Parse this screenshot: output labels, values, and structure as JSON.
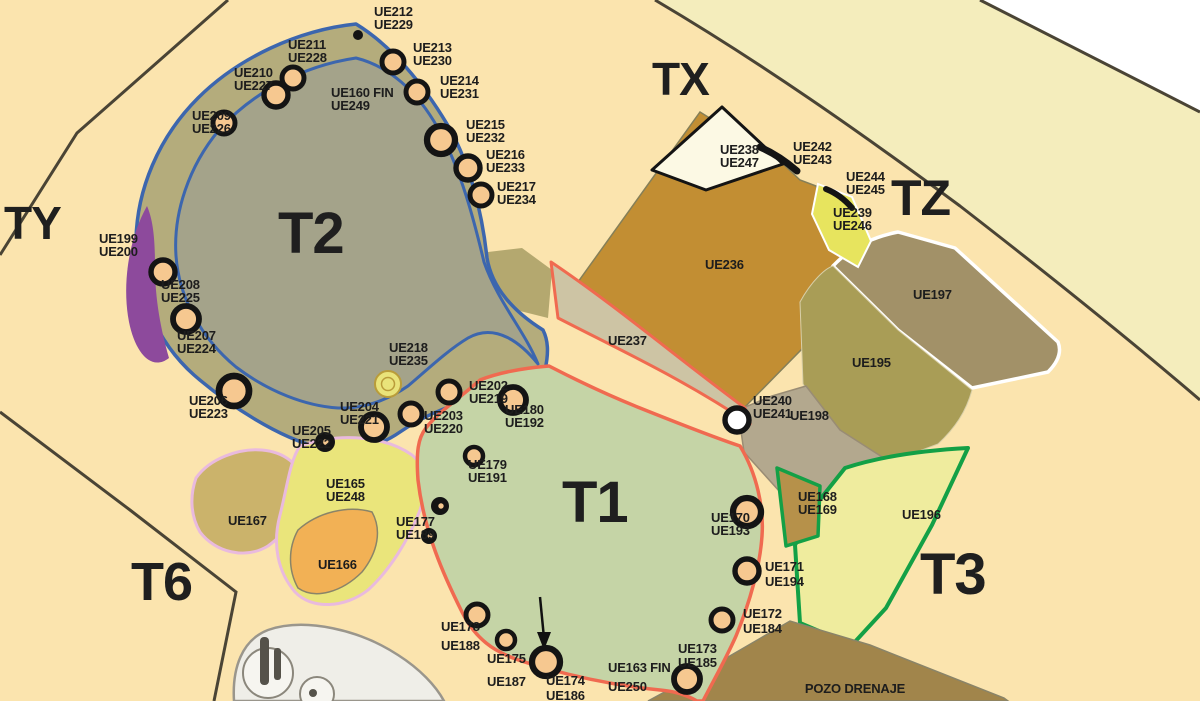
{
  "map": {
    "title": "Excavation sector plan",
    "colors": {
      "background_warm": "#fbe4ae",
      "background_light_band": "#f4edbc",
      "outside_white": "#ffffff",
      "t2_ring_band": "#b4ac7c",
      "t2_inner": "#a4a38a",
      "blue_border": "#3c66ae",
      "purple_patch": "#8d4a9c",
      "t1_green": "#c5d4a6",
      "red_border": "#f06a50",
      "ue237_sage": "#cdc4a4",
      "ue236_ochre": "#c28e33",
      "ue198_gray_tan": "#b3a88e",
      "ue195_olive": "#a99d56",
      "ue197_brown_gray": "#a29168",
      "ue196_pale": "#efec9e",
      "green_border": "#13a046",
      "ue168_tan": "#b6914a",
      "ue239_yellow_green": "#e7e45e",
      "ue167_tan": "#cbb36b",
      "ue165_yellow": "#eae57b",
      "ue166_orange": "#f2b155",
      "pink_border": "#e9bade",
      "pozo_brown": "#a1854b",
      "boundary_dark": "#4a4435",
      "feature_fill": "#f6c890",
      "feature_stroke": "#141414"
    },
    "zones": [
      {
        "label": "T2",
        "x": 278,
        "y": 253,
        "s": 58
      },
      {
        "label": "T1",
        "x": 562,
        "y": 522,
        "s": 58
      },
      {
        "label": "TX",
        "x": 652,
        "y": 95,
        "s": 46
      },
      {
        "label": "TY",
        "x": 4,
        "y": 239,
        "s": 46
      },
      {
        "label": "TZ",
        "x": 891,
        "y": 215,
        "s": 50
      },
      {
        "label": "T3",
        "x": 920,
        "y": 594,
        "s": 58
      },
      {
        "label": "T6",
        "x": 131,
        "y": 600,
        "s": 54
      }
    ],
    "unit_labels": [
      {
        "lines": [
          "UE212",
          "UE229"
        ],
        "x": 374,
        "y": 16
      },
      {
        "lines": [
          "UE211",
          "UE228"
        ],
        "x": 288,
        "y": 49
      },
      {
        "lines": [
          "UE213",
          "UE230"
        ],
        "x": 413,
        "y": 52
      },
      {
        "lines": [
          "UE210",
          "UE227"
        ],
        "x": 234,
        "y": 77
      },
      {
        "lines": [
          "UE214",
          "UE231"
        ],
        "x": 440,
        "y": 85
      },
      {
        "lines": [
          "UE160 FIN",
          "UE249"
        ],
        "x": 331,
        "y": 97
      },
      {
        "lines": [
          "UE209",
          "UE226"
        ],
        "x": 192,
        "y": 120
      },
      {
        "lines": [
          "UE215",
          "UE232"
        ],
        "x": 466,
        "y": 129
      },
      {
        "lines": [
          "UE216",
          "UE233"
        ],
        "x": 486,
        "y": 159
      },
      {
        "lines": [
          "UE217",
          "UE234"
        ],
        "x": 497,
        "y": 191
      },
      {
        "lines": [
          "UE199",
          "UE200"
        ],
        "x": 99,
        "y": 243
      },
      {
        "lines": [
          "UE208",
          "UE225"
        ],
        "x": 161,
        "y": 289
      },
      {
        "lines": [
          "UE207",
          "UE224"
        ],
        "x": 177,
        "y": 340
      },
      {
        "lines": [
          "UE218",
          "UE235"
        ],
        "x": 389,
        "y": 352
      },
      {
        "lines": [
          "UE206",
          "UE223"
        ],
        "x": 189,
        "y": 405
      },
      {
        "lines": [
          "UE202",
          "UE219"
        ],
        "x": 469,
        "y": 390
      },
      {
        "lines": [
          "UE204",
          "UE221"
        ],
        "x": 340,
        "y": 411
      },
      {
        "lines": [
          "UE180",
          "UE192"
        ],
        "x": 505,
        "y": 414
      },
      {
        "lines": [
          "UE203",
          "UE220"
        ],
        "x": 424,
        "y": 420
      },
      {
        "lines": [
          "UE205",
          "UE222"
        ],
        "x": 292,
        "y": 435
      },
      {
        "lines": [
          "UE179",
          "UE191"
        ],
        "x": 468,
        "y": 469
      },
      {
        "lines": [
          "UE165",
          "UE248"
        ],
        "x": 326,
        "y": 488
      },
      {
        "lines": [
          "UE177",
          "UE189"
        ],
        "x": 396,
        "y": 526
      },
      {
        "lines": [
          "UE167"
        ],
        "x": 228,
        "y": 525
      },
      {
        "lines": [
          "UE166"
        ],
        "x": 318,
        "y": 569
      },
      {
        "lines": [
          "UE178",
          "UE188"
        ],
        "x": 441,
        "y": 631,
        "dy": 19
      },
      {
        "lines": [
          "UE175",
          "UE187"
        ],
        "x": 487,
        "y": 663,
        "dy": 23
      },
      {
        "lines": [
          "UE174",
          "UE186"
        ],
        "x": 546,
        "y": 685,
        "dy": 15
      },
      {
        "lines": [
          "UE163 FIN",
          "UE250"
        ],
        "x": 608,
        "y": 672,
        "dy": 19
      },
      {
        "lines": [
          "UE173",
          "UE185"
        ],
        "x": 678,
        "y": 653,
        "dy": 14
      },
      {
        "lines": [
          "UE170",
          "UE193"
        ],
        "x": 711,
        "y": 522
      },
      {
        "lines": [
          "UE171",
          "UE194"
        ],
        "x": 765,
        "y": 571,
        "dy": 15
      },
      {
        "lines": [
          "UE172",
          "UE184"
        ],
        "x": 743,
        "y": 618,
        "dy": 15
      },
      {
        "lines": [
          "UE168",
          "UE169"
        ],
        "x": 798,
        "y": 501
      },
      {
        "lines": [
          "UE240",
          "UE241"
        ],
        "x": 753,
        "y": 405
      },
      {
        "lines": [
          "UE198"
        ],
        "x": 790,
        "y": 420
      },
      {
        "lines": [
          "UE195"
        ],
        "x": 852,
        "y": 367
      },
      {
        "lines": [
          "UE197"
        ],
        "x": 913,
        "y": 299
      },
      {
        "lines": [
          "UE196"
        ],
        "x": 902,
        "y": 519
      },
      {
        "lines": [
          "UE236"
        ],
        "x": 705,
        "y": 269
      },
      {
        "lines": [
          "UE237"
        ],
        "x": 608,
        "y": 345
      },
      {
        "lines": [
          "UE238",
          "UE247"
        ],
        "x": 720,
        "y": 154
      },
      {
        "lines": [
          "UE242",
          "UE243"
        ],
        "x": 793,
        "y": 151
      },
      {
        "lines": [
          "UE244",
          "UE245"
        ],
        "x": 846,
        "y": 181
      },
      {
        "lines": [
          "UE239",
          "UE246"
        ],
        "x": 833,
        "y": 217
      },
      {
        "lines": [
          "POZO DRENAJE"
        ],
        "x": 855,
        "y": 693,
        "anchor": "middle",
        "s": 15
      }
    ],
    "features": [
      {
        "t": "dot",
        "x": 358,
        "y": 35,
        "r": 5
      },
      {
        "t": "ring",
        "x": 393,
        "y": 62,
        "r": 11
      },
      {
        "t": "ring",
        "x": 417,
        "y": 92,
        "r": 11
      },
      {
        "t": "ring",
        "x": 441,
        "y": 140,
        "r": 14
      },
      {
        "t": "ring",
        "x": 468,
        "y": 168,
        "r": 12
      },
      {
        "t": "ring",
        "x": 481,
        "y": 195,
        "r": 11
      },
      {
        "t": "ring",
        "x": 293,
        "y": 78,
        "r": 11
      },
      {
        "t": "ring",
        "x": 276,
        "y": 95,
        "r": 12
      },
      {
        "t": "ring",
        "x": 224,
        "y": 123,
        "r": 11
      },
      {
        "t": "ring",
        "x": 163,
        "y": 272,
        "r": 12
      },
      {
        "t": "ring",
        "x": 186,
        "y": 319,
        "r": 13
      },
      {
        "t": "ring",
        "x": 234,
        "y": 391,
        "r": 15
      },
      {
        "t": "blob",
        "x": 325,
        "y": 442,
        "r": 10
      },
      {
        "t": "ring",
        "x": 374,
        "y": 427,
        "r": 13
      },
      {
        "t": "ring",
        "x": 411,
        "y": 414,
        "r": 11
      },
      {
        "t": "ring",
        "x": 449,
        "y": 392,
        "r": 11
      },
      {
        "t": "yellow",
        "x": 388,
        "y": 384,
        "r": 13
      },
      {
        "t": "ring",
        "x": 513,
        "y": 400,
        "r": 13
      },
      {
        "t": "ring",
        "x": 474,
        "y": 456,
        "r": 9
      },
      {
        "t": "blob",
        "x": 440,
        "y": 506,
        "r": 9
      },
      {
        "t": "blob",
        "x": 429,
        "y": 536,
        "r": 8
      },
      {
        "t": "ring",
        "x": 477,
        "y": 615,
        "r": 11
      },
      {
        "t": "ring",
        "x": 506,
        "y": 640,
        "r": 9
      },
      {
        "t": "ring",
        "x": 546,
        "y": 662,
        "r": 14
      },
      {
        "t": "ring",
        "x": 687,
        "y": 679,
        "r": 13
      },
      {
        "t": "ring",
        "x": 722,
        "y": 620,
        "r": 11
      },
      {
        "t": "ring",
        "x": 747,
        "y": 571,
        "r": 12
      },
      {
        "t": "ring",
        "x": 747,
        "y": 512,
        "r": 14
      },
      {
        "t": "white",
        "x": 737,
        "y": 420,
        "r": 12
      }
    ]
  }
}
